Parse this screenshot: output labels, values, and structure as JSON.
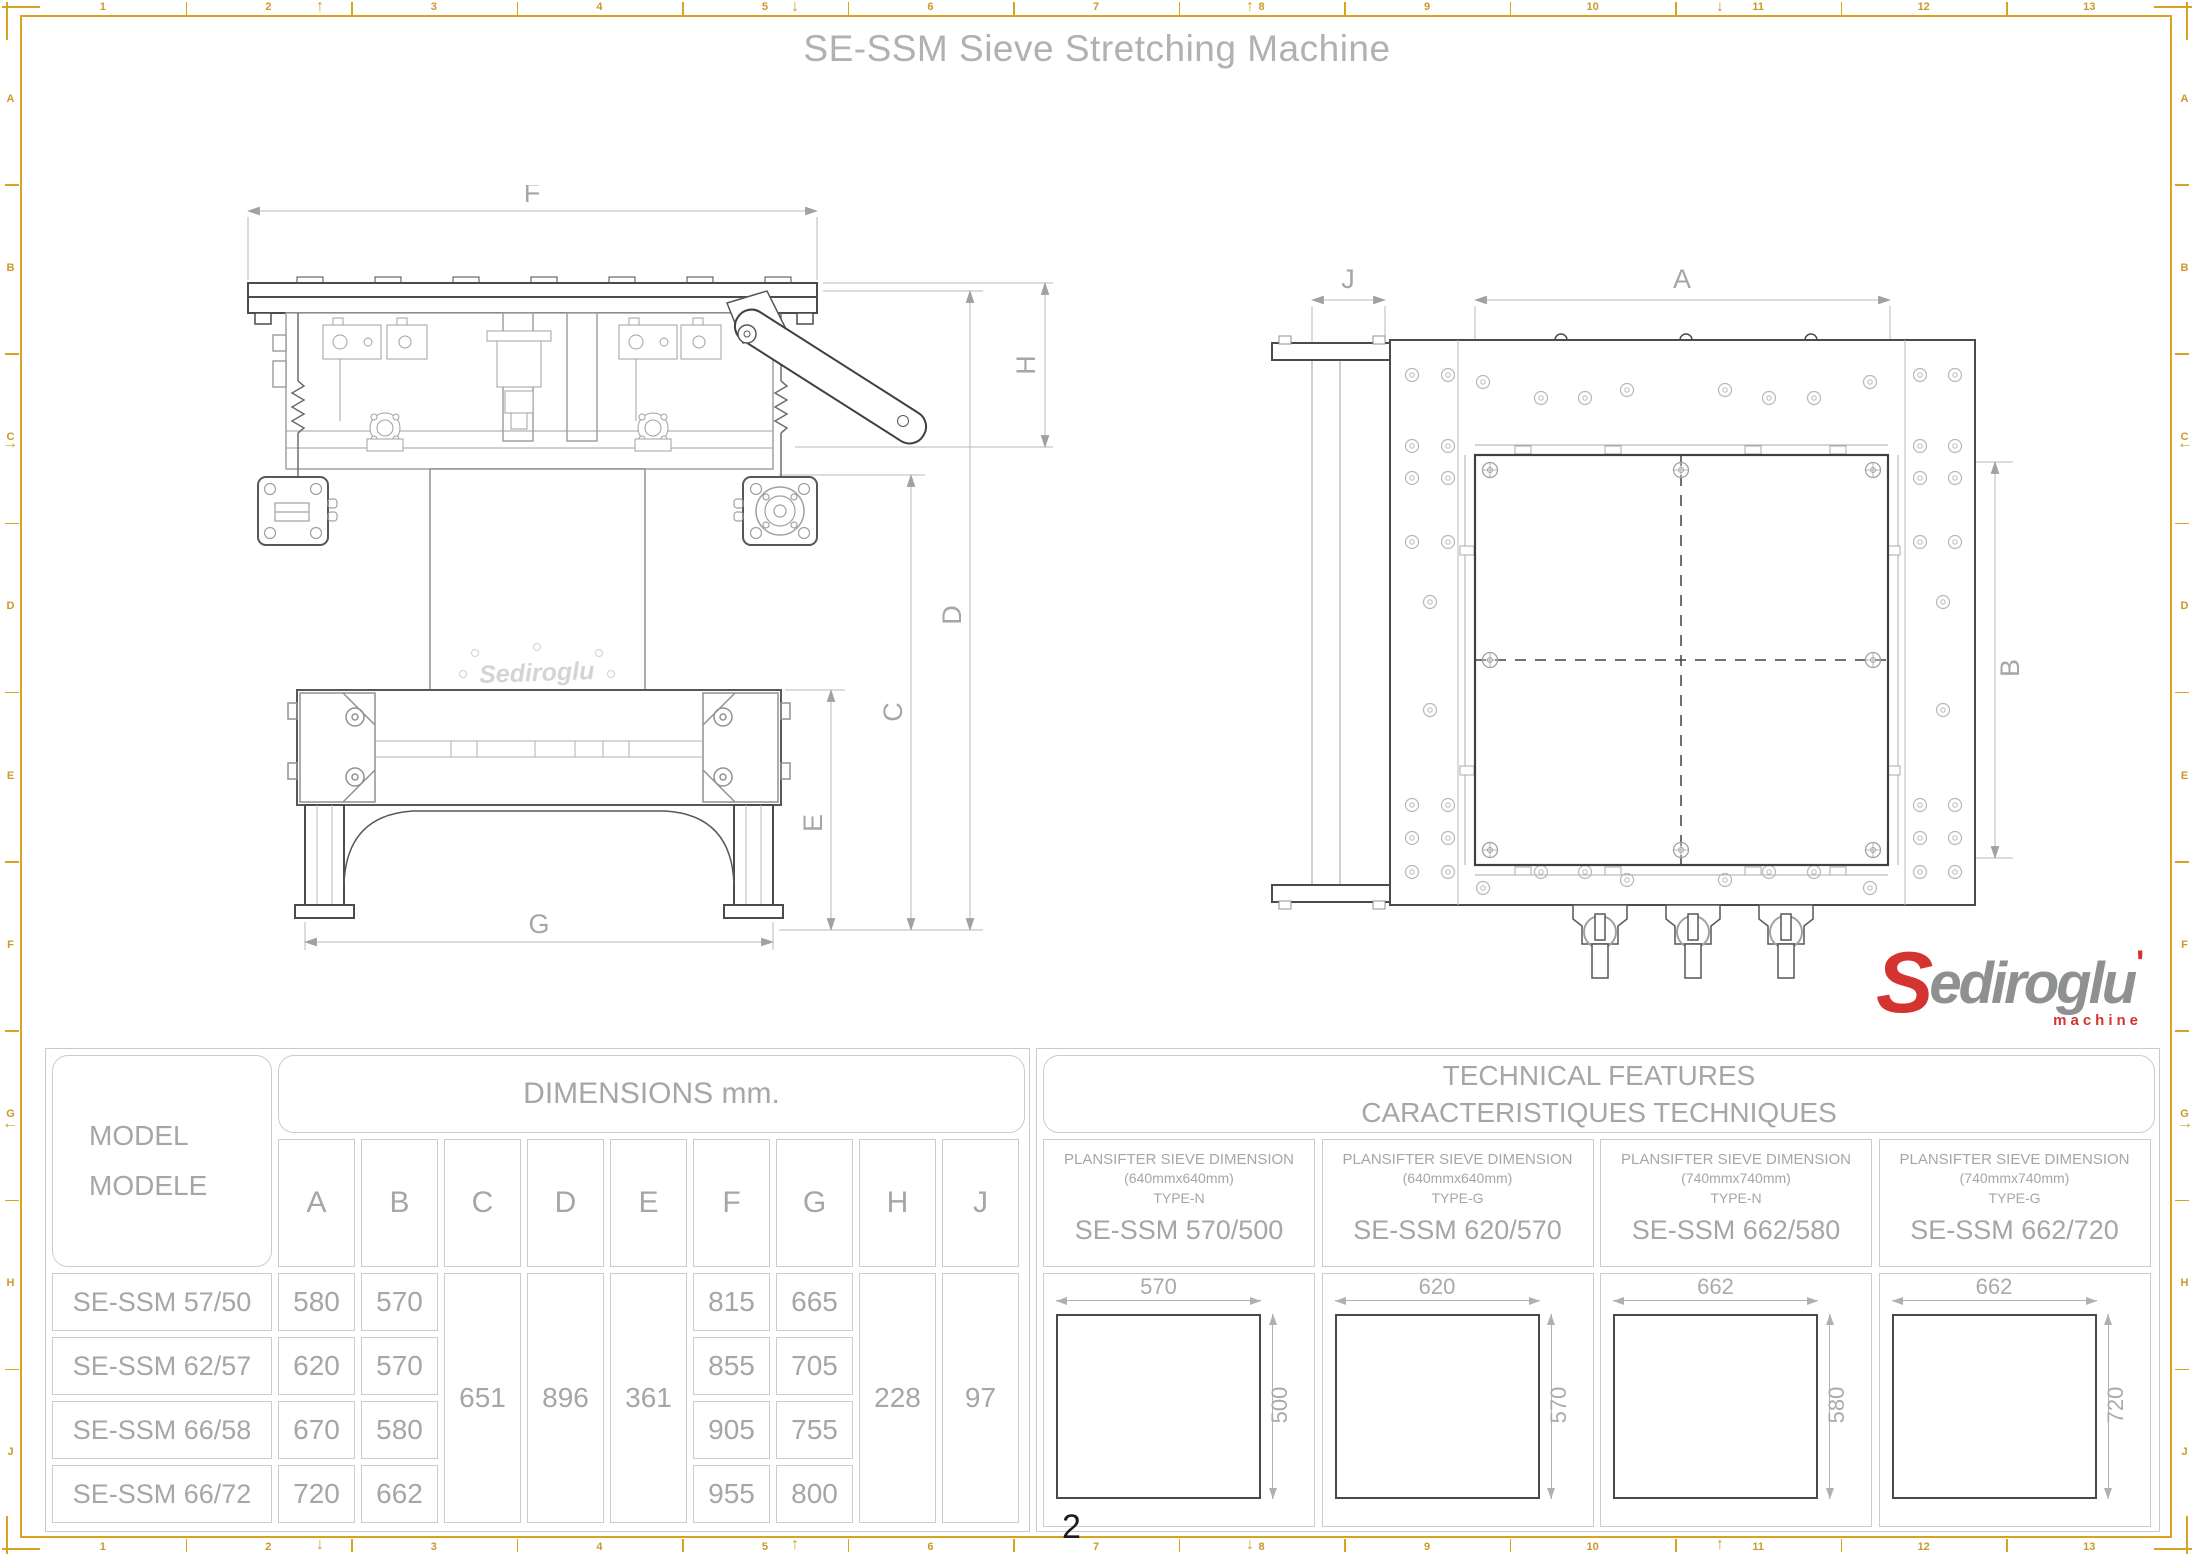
{
  "title": "SE-SSM Sieve Stretching Machine",
  "page_number": "2",
  "border": {
    "columns": [
      "1",
      "2",
      "3",
      "4",
      "5",
      "6",
      "7",
      "8",
      "9",
      "10",
      "11",
      "12",
      "13"
    ],
    "rows": [
      "A",
      "B",
      "C",
      "D",
      "E",
      "F",
      "G",
      "H",
      "J"
    ],
    "fold_marks": {
      "top": [
        {
          "x": 320,
          "g": "↑"
        },
        {
          "x": 795,
          "g": "↓"
        },
        {
          "x": 1250,
          "g": "↑"
        },
        {
          "x": 1720,
          "g": "↓"
        }
      ],
      "bottom": [
        {
          "x": 320,
          "g": "↓"
        },
        {
          "x": 795,
          "g": "↑"
        },
        {
          "x": 1250,
          "g": "↓"
        },
        {
          "x": 1720,
          "g": "↑"
        }
      ],
      "left": [
        {
          "y": 445,
          "g": "→"
        },
        {
          "y": 1125,
          "g": "←"
        }
      ],
      "right": [
        {
          "y": 445,
          "g": "←"
        },
        {
          "y": 1125,
          "g": "→"
        }
      ]
    },
    "color": "#d7a420"
  },
  "front_view": {
    "labels": {
      "F": "F",
      "H": "H",
      "D": "D",
      "C": "C",
      "E": "E",
      "G": "G"
    },
    "emboss": "Sediroglu"
  },
  "top_view": {
    "labels": {
      "J": "J",
      "A": "A",
      "B": "B"
    }
  },
  "logo": {
    "s": "S",
    "rest": "ediroglu",
    "mark": "'",
    "sub": "machine",
    "red": "#d43430",
    "gray": "#8e9092"
  },
  "table": {
    "model_header_1": "MODEL",
    "model_header_2": "MODELE",
    "dimensions_header": "DIMENSIONS mm.",
    "dim_columns": [
      "A",
      "B",
      "C",
      "D",
      "E",
      "F",
      "G",
      "H",
      "J"
    ],
    "rows": [
      {
        "model": "SE-SSM 57/50",
        "A": "580",
        "B": "570",
        "F": "815",
        "G": "665"
      },
      {
        "model": "SE-SSM 62/57",
        "A": "620",
        "B": "570",
        "F": "855",
        "G": "705"
      },
      {
        "model": "SE-SSM 66/58",
        "A": "670",
        "B": "580",
        "F": "905",
        "G": "755"
      },
      {
        "model": "SE-SSM 66/72",
        "A": "720",
        "B": "662",
        "F": "955",
        "G": "800"
      }
    ],
    "merged": {
      "C": "651",
      "D": "896",
      "E": "361",
      "H": "228",
      "J": "97"
    },
    "tech_header_1": "TECHNICAL FEATURES",
    "tech_header_2": "CARACTERISTIQUES TECHNIQUES",
    "tech_columns": [
      {
        "line1": "PLANSIFTER SIEVE DIMENSION",
        "line2": "(640mmx640mm)",
        "line3": "TYPE-N",
        "name": "SE-SSM 570/500",
        "width": "570",
        "height": "500"
      },
      {
        "line1": "PLANSIFTER SIEVE DIMENSION",
        "line2": "(640mmx640mm)",
        "line3": "TYPE-G",
        "name": "SE-SSM 620/570",
        "width": "620",
        "height": "570"
      },
      {
        "line1": "PLANSIFTER SIEVE DIMENSION",
        "line2": "(740mmx740mm)",
        "line3": "TYPE-N",
        "name": "SE-SSM 662/580",
        "width": "662",
        "height": "580"
      },
      {
        "line1": "PLANSIFTER SIEVE DIMENSION",
        "line2": "(740mmx740mm)",
        "line3": "TYPE-G",
        "name": "SE-SSM 662/720",
        "width": "662",
        "height": "720"
      }
    ]
  }
}
